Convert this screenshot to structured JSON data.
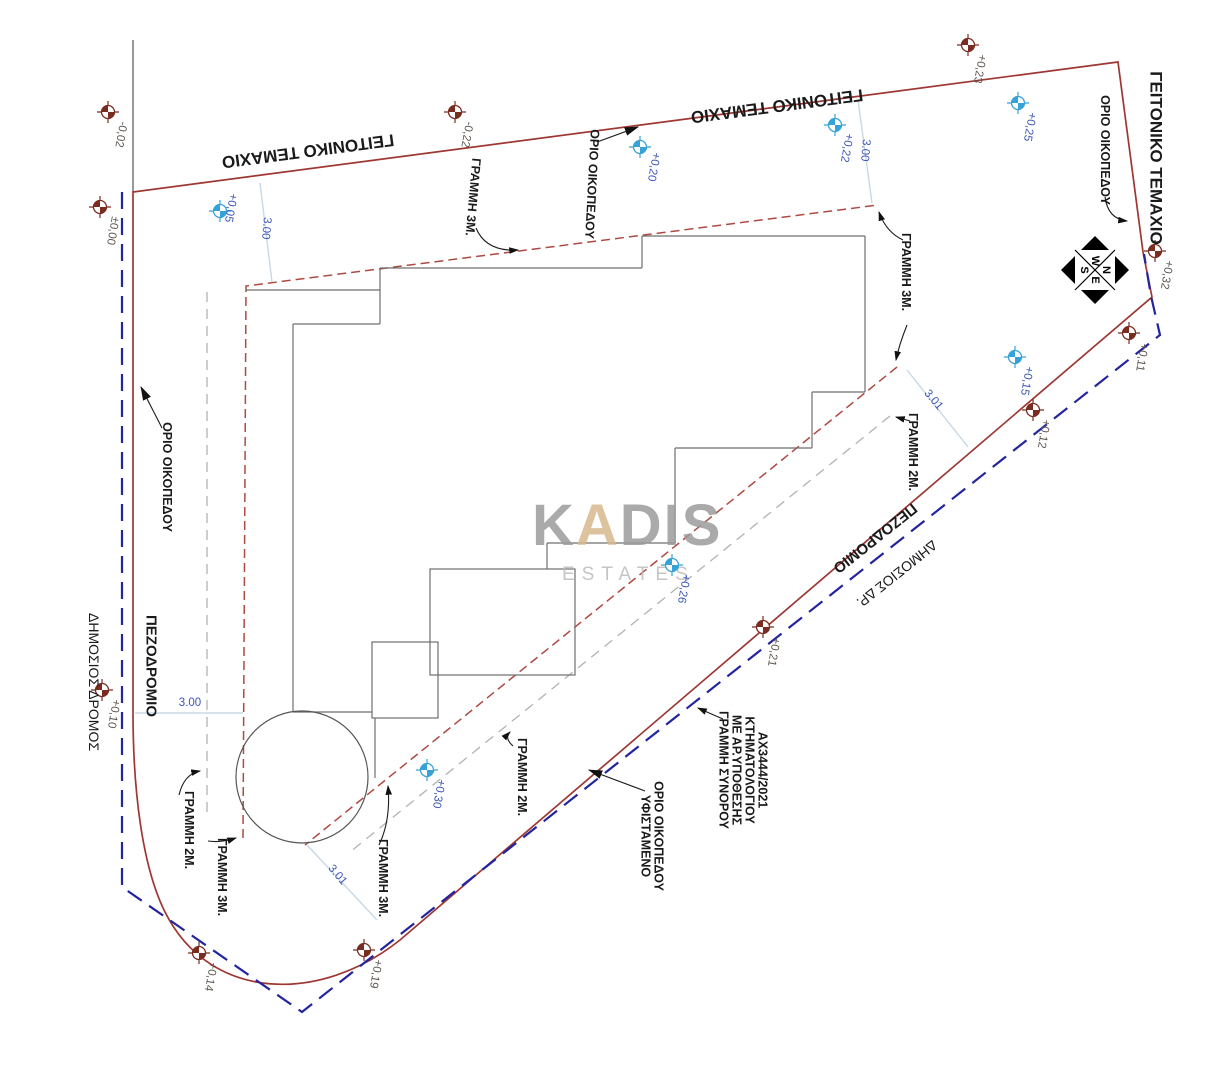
{
  "plan": {
    "watermark": {
      "word": "KADIS",
      "word_parts": {
        "before": "K",
        "accent": "A",
        "after": "DIS"
      },
      "subword": "ESTATES",
      "gray": "#9c9c9c",
      "sub_gray": "#bcbcbc",
      "accent": "#d6b98e"
    },
    "compass": {
      "top": "W",
      "right": "N",
      "bottom": "E",
      "left": "S"
    },
    "colors": {
      "plot_boundary_red": "#9e3732",
      "cadastral_blue": "#23249f",
      "setback_red_dash": "#ad4a42",
      "setback_gray_dash": "#b2b2b2",
      "building_gray": "#6f6f6f",
      "dim_line": "#c8d8e6",
      "dim_text": "#3b55b8",
      "benchmark_brown": "#7a2c20",
      "benchmark_blue": "#35a2d8",
      "label_black": "#1a1a1a",
      "brown_label_text": "#5f5750"
    },
    "region_labels": [
      {
        "id": "neighbor-parcel-top-left",
        "text": "ΓΕΙΤΟΝΙΚΟ ΤΕΜΑΧΙΟ",
        "x": 308,
        "y": 151,
        "rot": 172.5,
        "size": 17,
        "bold": true
      },
      {
        "id": "neighbor-parcel-top-right",
        "text": "ΓΕΙΤΟΝΙΚΟ ΤΕΜΑΧΙΟ",
        "x": 777,
        "y": 106,
        "rot": 172.5,
        "size": 17,
        "bold": true
      },
      {
        "id": "neighbor-parcel-right",
        "text": "ΓΕΙΤΟΝΙΚΟ ΤΕΜΑΧΙΟ",
        "x": 1156,
        "y": 158,
        "rot": 90,
        "size": 17,
        "bold": true
      },
      {
        "id": "sidewalk-left",
        "text": "ΠΕΖΟΔΡΟΜΙΟ",
        "x": 151,
        "y": 666,
        "rot": 90,
        "size": 15,
        "bold": true
      },
      {
        "id": "public-road-left",
        "text": "ΔΗΜΟΣΙΟΣ  ΔΡΟΜΟΣ",
        "x": 94,
        "y": 682,
        "rot": 90,
        "size": 14,
        "bold": false
      },
      {
        "id": "sidewalk-diagonal",
        "text": "ΠΕΖΟΔΡΟΜΙΟ",
        "x": 875,
        "y": 538,
        "rot": 141.5,
        "size": 15,
        "bold": true
      },
      {
        "id": "public-road-diagonal",
        "text": "ΔΗΜΟΣΙΟΣ  ΔΡ.",
        "x": 897,
        "y": 574,
        "rot": 141.5,
        "size": 14,
        "bold": false
      }
    ],
    "annotations": [
      {
        "id": "plot-limit-top",
        "lines": [
          "ΟΡΙΟ ΟΙΚΟΠΕΔΟΥ"
        ],
        "x": 592,
        "y": 184,
        "rot": 93
      },
      {
        "id": "line-3m-top-left",
        "lines": [
          "ΓΡΑΜΜΗ 3Μ."
        ],
        "x": 473,
        "y": 197,
        "rot": 95
      },
      {
        "id": "plot-limit-right",
        "lines": [
          "ΟΡΙΟ ΟΙΚΟΠΕΔΟΥ"
        ],
        "x": 1105,
        "y": 150,
        "rot": 90
      },
      {
        "id": "line-3m-mid-right",
        "lines": [
          "ΓΡΑΜΜΗ 3Μ."
        ],
        "x": 906,
        "y": 272,
        "rot": 90
      },
      {
        "id": "line-2m-right",
        "lines": [
          "ΓΡΑΜΜΗ 2Μ."
        ],
        "x": 913,
        "y": 452,
        "rot": 90
      },
      {
        "id": "plot-limit-left",
        "lines": [
          "ΟΡΙΟ ΟΙΚΟΠΕΔΟΥ"
        ],
        "x": 167,
        "y": 477,
        "rot": 90
      },
      {
        "id": "line-2m-bottom-left",
        "lines": [
          "ΓΡΑΜΜΗ 2Μ."
        ],
        "x": 189,
        "y": 830,
        "rot": 90
      },
      {
        "id": "line-3m-bottom-left",
        "lines": [
          "ΓΡΑΜΜΗ 3Μ."
        ],
        "x": 222,
        "y": 877,
        "rot": 90
      },
      {
        "id": "line-3m-bottom-right",
        "lines": [
          "ΓΡΑΜΜΗ 3Μ."
        ],
        "x": 383,
        "y": 878,
        "rot": 90
      },
      {
        "id": "line-2m-bottom-mid",
        "lines": [
          "ΓΡΑΜΜΗ 2Μ."
        ],
        "x": 522,
        "y": 777,
        "rot": 90
      },
      {
        "id": "existing-plot-limit",
        "lines": [
          "ΥΦΙΣΤΑΜΕΝΟ",
          "ΟΡΙΟ ΟΙΚΟΠΕΔΟΥ"
        ],
        "x": 652,
        "y": 836,
        "rot": 90
      },
      {
        "id": "cadastral-border-note",
        "lines": [
          "ΓΡΑΜΜΗ ΣΥΝΟΡΟΥ",
          "ΜΕ ΑΡ.ΥΠΟΘΕΣΗΣ",
          "ΚΤΗΜΑΤΟΛΟΓΙΟΥ",
          "ΑΧ3444/2021"
        ],
        "x": 743,
        "y": 770,
        "rot": 90
      }
    ],
    "benchmarks": [
      {
        "value": "-0,02",
        "type": "brown",
        "x": 108,
        "y": 112,
        "lx": 120,
        "ly": 121
      },
      {
        "value": "±0,00",
        "type": "brown",
        "x": 100,
        "y": 207,
        "lx": 112,
        "ly": 216
      },
      {
        "value": "+0,05",
        "type": "blue",
        "x": 220,
        "y": 211,
        "lx": 230,
        "ly": 193
      },
      {
        "value": "-0,22",
        "type": "brown",
        "x": 455,
        "y": 112,
        "lx": 466,
        "ly": 121
      },
      {
        "value": "+0,20",
        "type": "blue",
        "x": 640,
        "y": 147,
        "lx": 653,
        "ly": 152
      },
      {
        "value": "+0,23",
        "type": "brown",
        "x": 968,
        "y": 45,
        "lx": 979,
        "ly": 54
      },
      {
        "value": "+0,22",
        "type": "blue",
        "x": 835,
        "y": 125,
        "lx": 846,
        "ly": 133
      },
      {
        "value": "+0,25",
        "type": "blue",
        "x": 1018,
        "y": 103,
        "lx": 1029,
        "ly": 112
      },
      {
        "value": "+0,32",
        "type": "brown",
        "x": 1155,
        "y": 251,
        "lx": 1166,
        "ly": 260
      },
      {
        "value": "+0,11",
        "type": "brown",
        "x": 1129,
        "y": 333,
        "lx": 1141,
        "ly": 343
      },
      {
        "value": "+0,15",
        "type": "blue",
        "x": 1015,
        "y": 357,
        "lx": 1026,
        "ly": 366
      },
      {
        "value": "+0,12",
        "type": "brown",
        "x": 1033,
        "y": 410,
        "lx": 1043,
        "ly": 419
      },
      {
        "value": "+0,26",
        "type": "blue",
        "x": 672,
        "y": 565,
        "lx": 683,
        "ly": 574
      },
      {
        "value": "+0,21",
        "type": "brown",
        "x": 763,
        "y": 627,
        "lx": 773,
        "ly": 637
      },
      {
        "value": "+0,30",
        "type": "blue",
        "x": 427,
        "y": 770,
        "lx": 438,
        "ly": 779
      },
      {
        "value": "+0,10",
        "type": "brown",
        "x": 102,
        "y": 690,
        "lx": 113,
        "ly": 699
      },
      {
        "value": "+0,14",
        "type": "brown",
        "x": 199,
        "y": 953,
        "lx": 210,
        "ly": 962
      },
      {
        "value": "+0,19",
        "type": "brown",
        "x": 364,
        "y": 950,
        "lx": 375,
        "ly": 959
      }
    ],
    "dimensions": [
      {
        "text": "3.00",
        "x1": 260,
        "y1": 183,
        "x2": 272,
        "y2": 282,
        "lx": 263,
        "ly": 228,
        "rot": 95
      },
      {
        "text": "3.00",
        "x1": 858,
        "y1": 100,
        "x2": 872,
        "y2": 203,
        "lx": 862,
        "ly": 150,
        "rot": 95
      },
      {
        "text": "3.01",
        "x1": 907,
        "y1": 370,
        "x2": 968,
        "y2": 447,
        "lx": 931,
        "ly": 402,
        "rot": 50
      },
      {
        "text": "3.01",
        "x1": 307,
        "y1": 845,
        "x2": 377,
        "y2": 920,
        "lx": 335,
        "ly": 877,
        "rot": 50
      },
      {
        "text": "3.00",
        "x1": 135,
        "y1": 713,
        "x2": 243,
        "y2": 713,
        "lx": 190,
        "ly": 706,
        "rot": 0
      }
    ]
  }
}
